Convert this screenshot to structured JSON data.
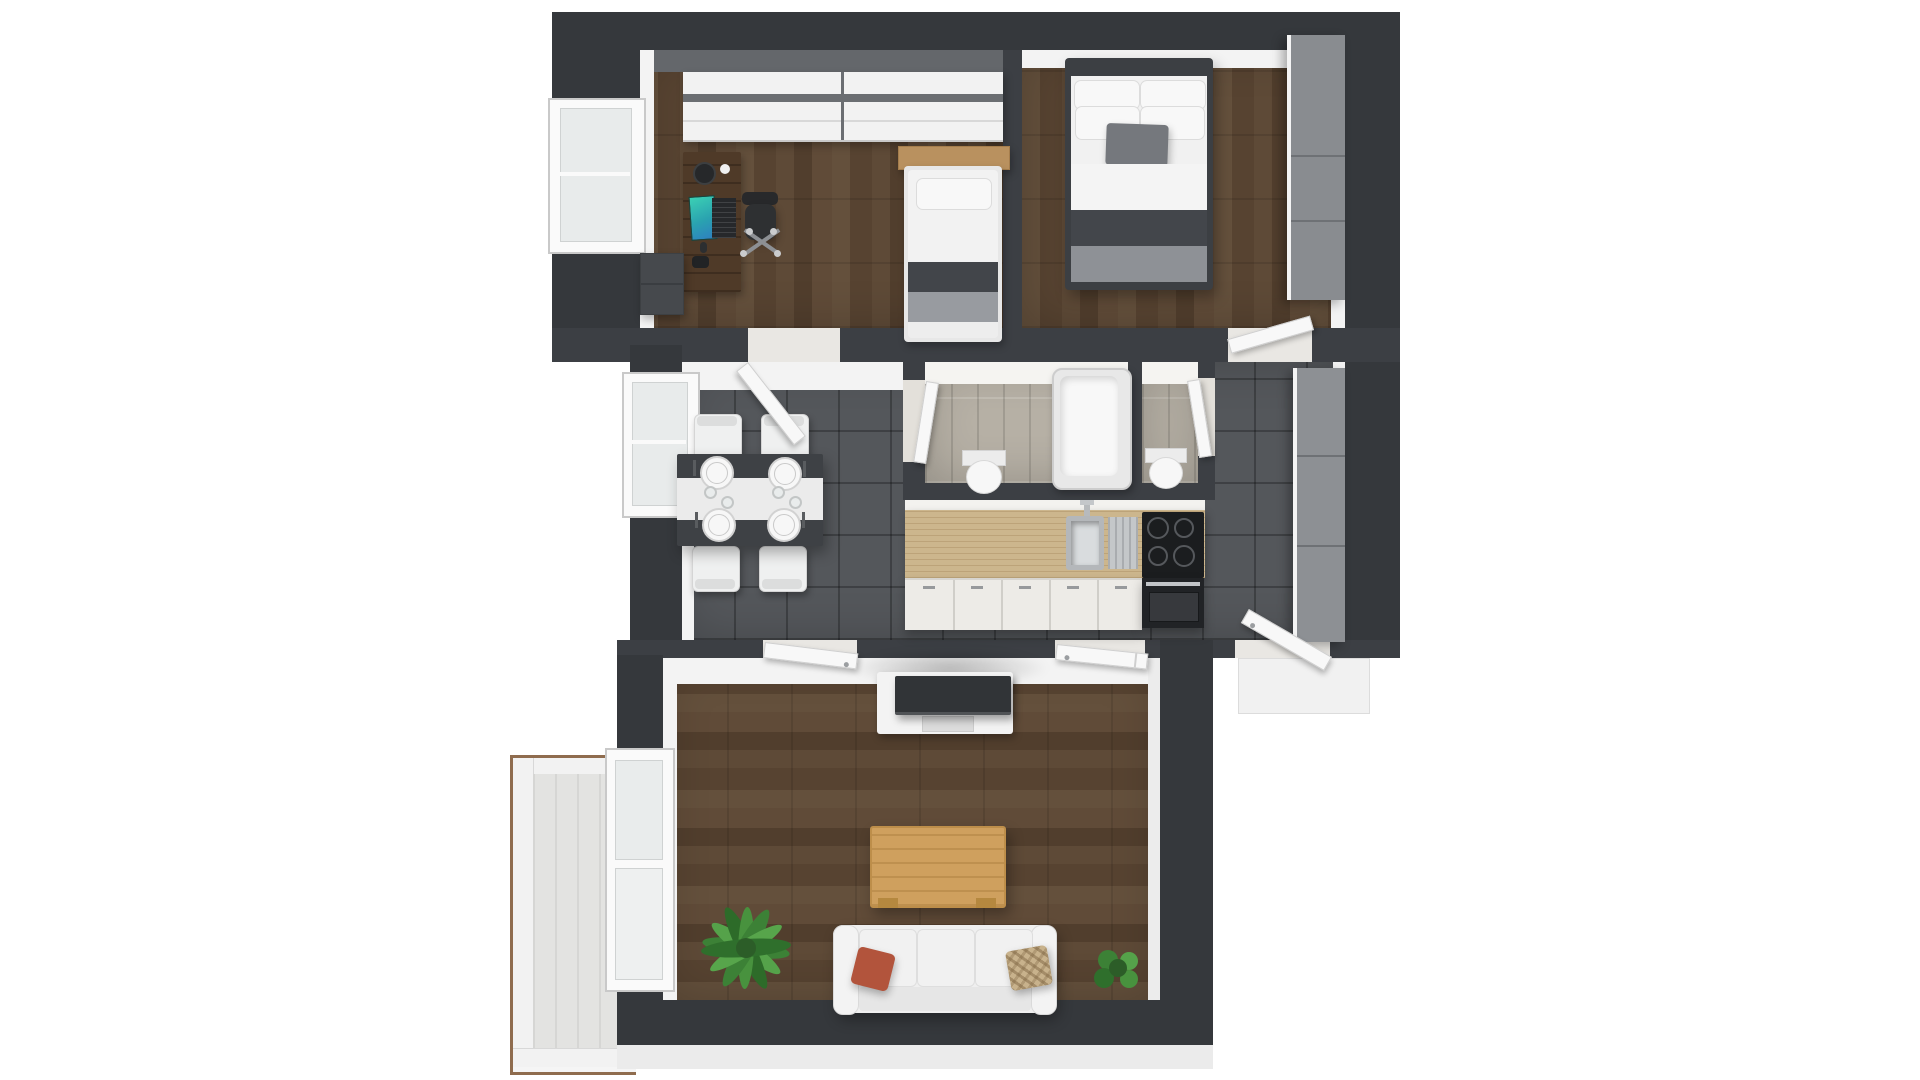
{
  "scene": {
    "title": "3D apartment floor plan render, top-down view",
    "background": "#ffffff",
    "palette": {
      "exterior_wall": "#35383c",
      "interior_wall": "#3c3f44",
      "dark_wood_floor": "#5a4634",
      "hall_tile": "#54575b",
      "bath_tile": "#b6b0a5",
      "balcony_floor": "#e3e3e1",
      "furniture_white": "#f2f2f2",
      "blanket_gray": "#8e9196",
      "bed_band_gray": "#43464b",
      "counter_wood": "#ccb68d",
      "appliance_black": "#1b1d1f",
      "coffee_table_oak": "#cfa05e",
      "desk_walnut": "#4f3a28",
      "headboard_oak": "#b9915f",
      "accent_pillow_red": "#b2543c",
      "accent_pillow_beige": "#c8b28c",
      "plant_green": "#4c9243",
      "wardrobe_gray": "#898c90"
    },
    "rooms": [
      {
        "id": "office",
        "label": "Office / kids room",
        "floor": "dark wood planks",
        "furniture": [
          "white wardrobe with gray stripe (2 units)",
          "walnut desk",
          "laptop with teal screen",
          "black laptop",
          "headphones",
          "mug",
          "mouse",
          "gamepad",
          "black office chair on star base",
          "dark dresser",
          "single bed with oak headboard"
        ]
      },
      {
        "id": "bedroom",
        "label": "Bedroom",
        "floor": "dark wood planks",
        "furniture": [
          "double bed with 4 white pillows",
          "gray accent pillow",
          "white duvet",
          "gray blanket",
          "tall gray wardrobe along right wall"
        ]
      },
      {
        "id": "hallway_dining",
        "label": "Hallway / dining / kitchen",
        "floor": "dark gray tiles",
        "furniture": [
          "dark dining table with white runner",
          "4 white plates with cutlery",
          "4 small glasses",
          "4 white chairs",
          "kitchen counter",
          "stainless sink with drainboard and faucet",
          "black 4-burner cooktop",
          "oven with chrome handle",
          "white cabinet fronts",
          "gray wardrobe along right wall"
        ]
      },
      {
        "id": "bathroom",
        "label": "Bathroom",
        "floor": "light tiles",
        "furniture": [
          "bathtub",
          "toilet"
        ]
      },
      {
        "id": "wc",
        "label": "WC",
        "floor": "light tiles",
        "furniture": [
          "toilet"
        ]
      },
      {
        "id": "living_room",
        "label": "Living room",
        "floor": "dark wood planks",
        "furniture": [
          "white TV sideboard",
          "flat TV lying on board",
          "oak coffee table",
          "white 3-seat sofa",
          "red pillow",
          "beige patterned pillow",
          "large plant",
          "small plant"
        ]
      },
      {
        "id": "balcony",
        "label": "Balcony",
        "floor": "light planks with wood-trimmed white railing",
        "furniture": []
      }
    ],
    "fixtures": {
      "windows": [
        "office left wall window",
        "hallway left wall window",
        "balcony door with window panel"
      ],
      "doors": [
        "office door",
        "bedroom door",
        "bathroom door",
        "wc door",
        "living room door left",
        "living room door right",
        "entrance door bottom right"
      ]
    },
    "counts": {
      "rooms": 7,
      "doors": 7,
      "windows": 3,
      "beds": 2,
      "toilets": 2,
      "plants": 2,
      "dining_chairs": 4
    }
  }
}
